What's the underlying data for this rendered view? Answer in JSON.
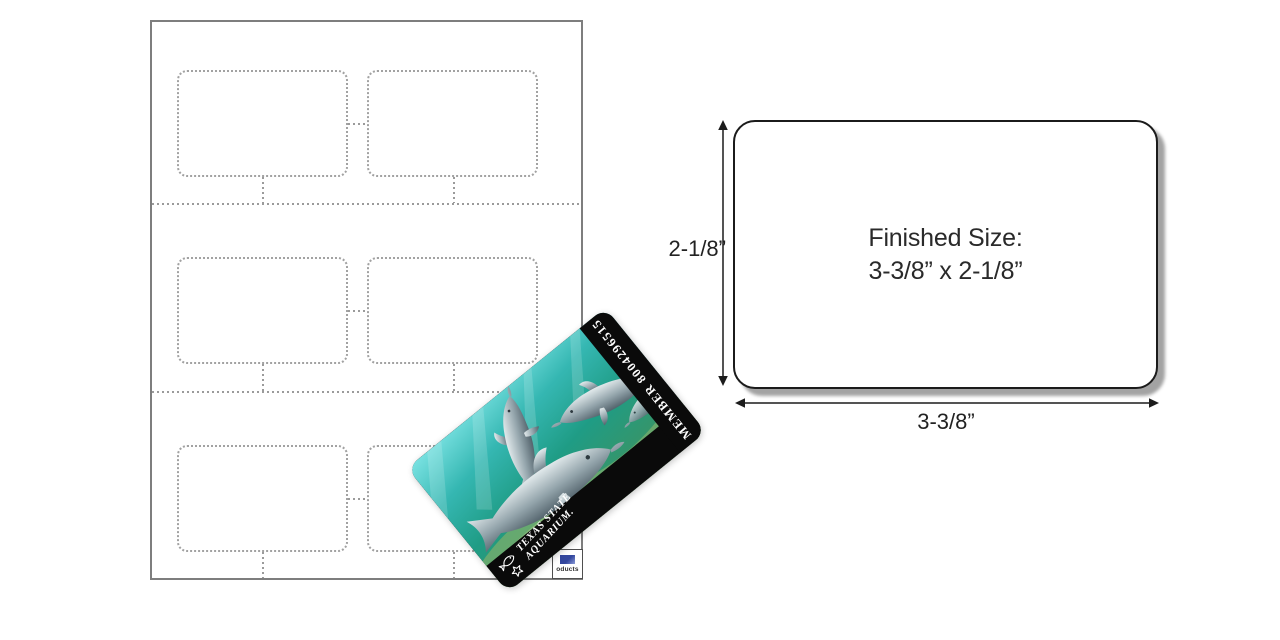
{
  "sheet": {
    "slot_count": 6,
    "rows": 3,
    "columns": 2,
    "brand_label_partial": "oducts"
  },
  "membership_card": {
    "member_line": "MEMBER 8004296515",
    "brand_line1": "TEXAS STATE",
    "brand_line2": "AQUARIUM.",
    "photo": "dolphins-underwater-photo"
  },
  "size_diagram": {
    "title_line1": "Finished Size:",
    "title_line2": "3-3/8” x 2-1/8”",
    "height_label": "2-1/8”",
    "width_label": "3-3/8”"
  },
  "colors": {
    "ink": "#2a2a2a",
    "card_outline": "#1b1b1b",
    "dotted_gray": "#9b9b9b",
    "sheet_border": "#7e7e7e",
    "band_black": "#0a0a0a",
    "water_teal": "#2fb3ae",
    "shadow_gray": "#a3a3a3",
    "chip_blue": "#33479e"
  }
}
